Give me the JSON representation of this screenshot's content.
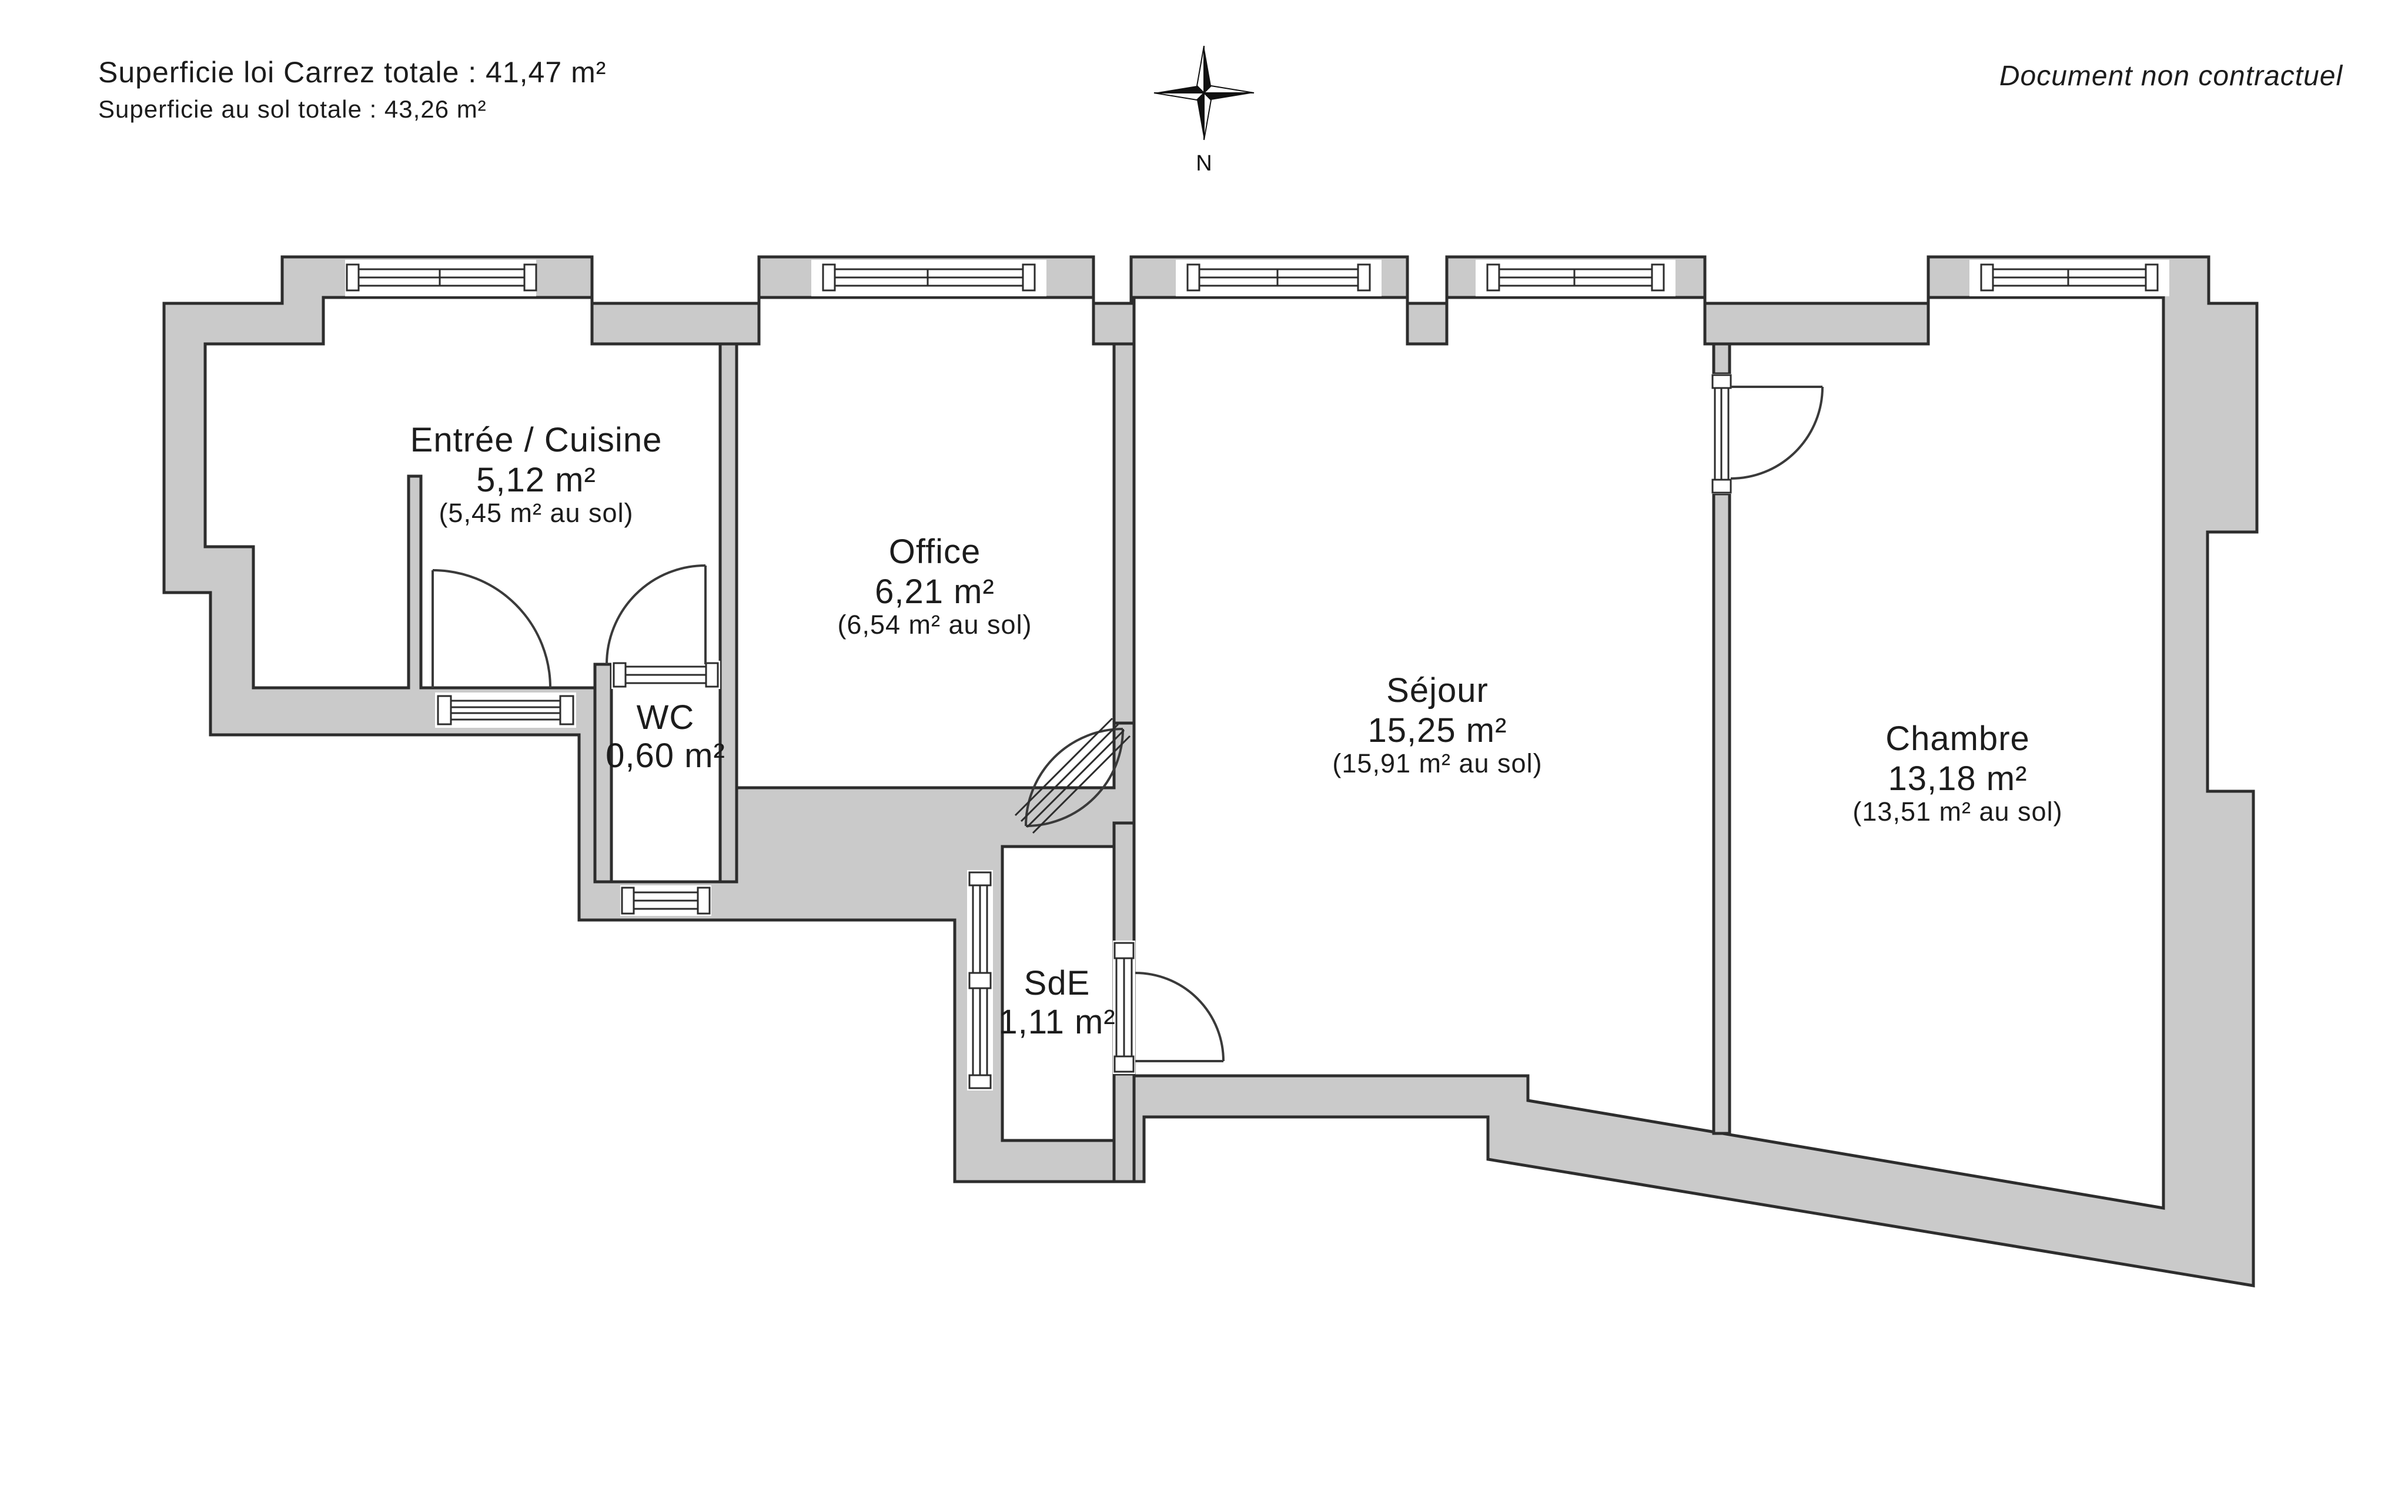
{
  "header": {
    "line1": "Superficie loi Carrez totale : 41,47 m²",
    "line2": "Superficie au sol totale : 43,26 m²",
    "disclaimer": "Document non contractuel"
  },
  "compass": {
    "label": "N"
  },
  "colors": {
    "wall_fill": "#cacaca",
    "line": "#2d2d2d",
    "background": "#ffffff"
  },
  "rooms": [
    {
      "id": "entree-cuisine",
      "name": "Entrée / Cuisine",
      "area": "5,12 m²",
      "floor_area": "(5,45 m² au sol)"
    },
    {
      "id": "office",
      "name": "Office",
      "area": "6,21 m²",
      "floor_area": "(6,54 m² au sol)"
    },
    {
      "id": "wc",
      "name": "WC",
      "area": "0,60 m²",
      "floor_area": ""
    },
    {
      "id": "sejour",
      "name": "Séjour",
      "area": "15,25 m²",
      "floor_area": "(15,91 m² au sol)"
    },
    {
      "id": "chambre",
      "name": "Chambre",
      "area": "13,18 m²",
      "floor_area": "(13,51 m² au sol)"
    },
    {
      "id": "sde",
      "name": "SdE",
      "area": "1,11 m²",
      "floor_area": ""
    }
  ]
}
